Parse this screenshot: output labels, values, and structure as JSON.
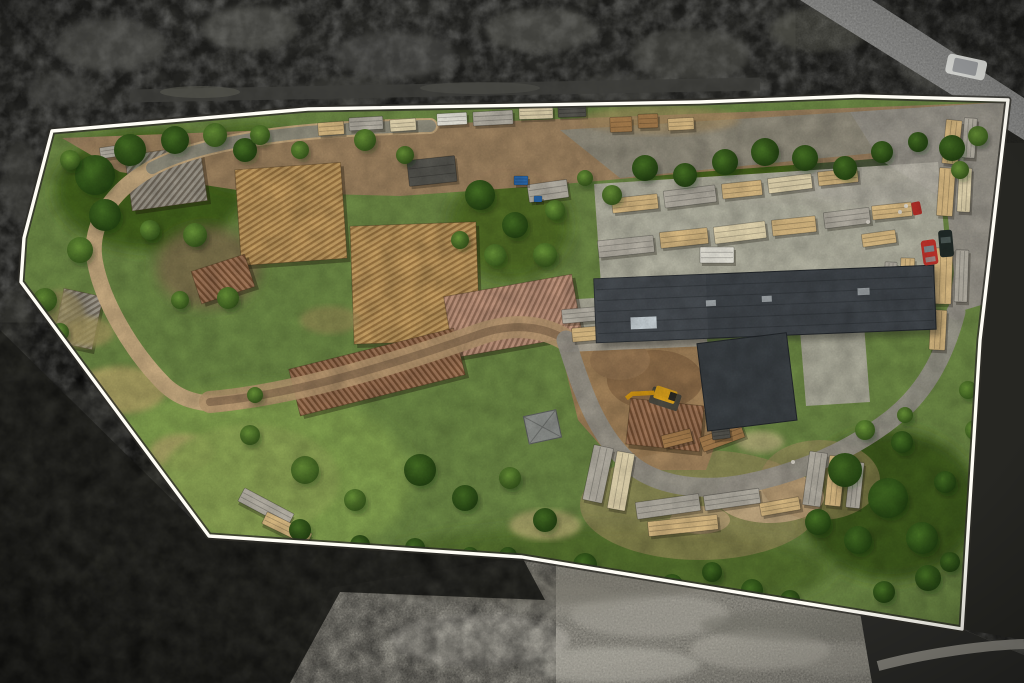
{
  "meta": {
    "description": "Top-down aerial drone photograph of a sawmill and lumber yard property. A white boundary outline highlights the parcel; terrain outside the boundary is desaturated grayscale forest and field, terrain inside is full-colour with green vegetation, dirt roads, log piles, sawn lumber stacks and a large dark-roofed warehouse.",
    "annotation_type": "property-boundary-overlay"
  },
  "boundary": {
    "points": "52,131 308,109 700,102 858,96 1008,100 980,340 962,629 522,557 209,536 21,282 24,238",
    "stroke": "#fffdf5",
    "halo": "#2e2d28"
  },
  "palette": {
    "forest_dark": "#2d2d2a",
    "forest_deep": "#262622",
    "field_gray": "#9b988e",
    "grass": "#6d8845",
    "meadow": "#83a04f",
    "dirt": "#a08262",
    "gravel": "#98948a",
    "concrete": "#b8b4a8",
    "sand": "#d9c49c",
    "road_loop": "#c6aa80",
    "road_track": "#7a6148"
  },
  "objects": {
    "warehouse": {
      "roof": "#41464b",
      "wing": "#3b4044",
      "panel": "#ccd5da"
    },
    "shed": {
      "roof": "#90938f"
    },
    "excavator": {
      "body": "#e2a71f",
      "tracks": "#4c4a40",
      "arm": "#d79a15"
    },
    "cars": {
      "red": "#c2342c",
      "black": "#232c29",
      "white_van": "#d3d4d0",
      "quad": "#b23029"
    }
  },
  "scene": {
    "trees": [
      [
        95,
        175,
        20,
        "d"
      ],
      [
        130,
        150,
        16,
        "d"
      ],
      [
        175,
        140,
        14,
        "d"
      ],
      [
        215,
        135,
        12,
        "m"
      ],
      [
        245,
        150,
        12,
        "d"
      ],
      [
        105,
        215,
        16,
        "d"
      ],
      [
        80,
        250,
        13,
        "m"
      ],
      [
        150,
        230,
        10,
        "m"
      ],
      [
        260,
        135,
        10,
        "m"
      ],
      [
        300,
        150,
        9,
        "m"
      ],
      [
        70,
        160,
        10,
        "m"
      ],
      [
        45,
        300,
        12,
        "m"
      ],
      [
        60,
        332,
        9,
        "m"
      ],
      [
        195,
        235,
        12,
        "m"
      ],
      [
        228,
        298,
        11,
        "m"
      ],
      [
        180,
        300,
        9,
        "m"
      ],
      [
        480,
        195,
        15,
        "d"
      ],
      [
        515,
        225,
        13,
        "d"
      ],
      [
        545,
        255,
        12,
        "m"
      ],
      [
        495,
        255,
        11,
        "m"
      ],
      [
        555,
        210,
        10,
        "m"
      ],
      [
        460,
        240,
        9,
        "m"
      ],
      [
        365,
        140,
        11,
        "m"
      ],
      [
        405,
        155,
        9,
        "m"
      ],
      [
        645,
        168,
        13,
        "d"
      ],
      [
        685,
        175,
        12,
        "d"
      ],
      [
        725,
        162,
        13,
        "d"
      ],
      [
        765,
        152,
        14,
        "d"
      ],
      [
        805,
        158,
        13,
        "d"
      ],
      [
        845,
        168,
        12,
        "d"
      ],
      [
        882,
        152,
        11,
        "d"
      ],
      [
        918,
        142,
        10,
        "d"
      ],
      [
        952,
        148,
        13,
        "d"
      ],
      [
        978,
        136,
        10,
        "m"
      ],
      [
        960,
        170,
        9,
        "m"
      ],
      [
        612,
        195,
        10,
        "m"
      ],
      [
        585,
        178,
        8,
        "m"
      ],
      [
        250,
        435,
        10,
        "m"
      ],
      [
        305,
        470,
        14,
        "m"
      ],
      [
        355,
        500,
        11,
        "m"
      ],
      [
        420,
        470,
        16,
        "d"
      ],
      [
        465,
        498,
        13,
        "d"
      ],
      [
        510,
        478,
        11,
        "m"
      ],
      [
        545,
        520,
        12,
        "d"
      ],
      [
        300,
        530,
        11,
        "d"
      ],
      [
        360,
        545,
        10,
        "d"
      ],
      [
        255,
        395,
        8,
        "m"
      ],
      [
        585,
        565,
        12,
        "d"
      ],
      [
        630,
        582,
        11,
        "d"
      ],
      [
        672,
        585,
        11,
        "d"
      ],
      [
        712,
        572,
        10,
        "d"
      ],
      [
        752,
        590,
        11,
        "d"
      ],
      [
        790,
        600,
        10,
        "d"
      ],
      [
        415,
        548,
        10,
        "d"
      ],
      [
        470,
        556,
        9,
        "d"
      ],
      [
        508,
        556,
        9,
        "d"
      ],
      [
        845,
        470,
        17,
        "d"
      ],
      [
        888,
        498,
        20,
        "d"
      ],
      [
        922,
        538,
        16,
        "d"
      ],
      [
        858,
        540,
        14,
        "d"
      ],
      [
        928,
        578,
        13,
        "d"
      ],
      [
        884,
        592,
        11,
        "d"
      ],
      [
        818,
        522,
        13,
        "d"
      ],
      [
        945,
        482,
        11,
        "d"
      ],
      [
        902,
        442,
        11,
        "d"
      ],
      [
        950,
        562,
        10,
        "d"
      ],
      [
        865,
        430,
        10,
        "m"
      ],
      [
        905,
        415,
        8,
        "m"
      ],
      [
        968,
        390,
        9,
        "m"
      ],
      [
        975,
        430,
        10,
        "m"
      ]
    ],
    "forest_highlights": [
      [
        110,
        45,
        55,
        26,
        "#5d5d58",
        0.55
      ],
      [
        250,
        28,
        48,
        22,
        "#65655f",
        0.5
      ],
      [
        395,
        55,
        60,
        24,
        "#575752",
        0.5
      ],
      [
        540,
        30,
        55,
        22,
        "#60605a",
        0.5
      ],
      [
        690,
        55,
        60,
        26,
        "#55554f",
        0.5
      ],
      [
        820,
        30,
        50,
        22,
        "#626259",
        0.5
      ],
      [
        940,
        70,
        40,
        20,
        "#6a6a64",
        0.45
      ],
      [
        60,
        90,
        35,
        16,
        "#4e4e49",
        0.5
      ],
      [
        350,
        90,
        45,
        14,
        "#454540",
        0.5
      ],
      [
        620,
        88,
        50,
        14,
        "#4a4a45",
        0.5
      ],
      [
        20,
        180,
        18,
        40,
        "#454540",
        0.5
      ],
      [
        15,
        340,
        16,
        50,
        "#3f3f3a",
        0.5
      ],
      [
        90,
        420,
        50,
        30,
        "#45453f",
        0.5
      ],
      [
        190,
        470,
        55,
        32,
        "#3f3f39",
        0.55
      ],
      [
        120,
        560,
        60,
        36,
        "#484842",
        0.5
      ],
      [
        270,
        600,
        55,
        30,
        "#3c3c37",
        0.5
      ],
      [
        60,
        645,
        45,
        26,
        "#44443e",
        0.5
      ],
      [
        360,
        640,
        50,
        26,
        "#3a3a35",
        0.45
      ],
      [
        300,
        520,
        40,
        22,
        "#42423c",
        0.5
      ],
      [
        430,
        600,
        40,
        24,
        "#3e3e38",
        0.45
      ],
      [
        1012,
        200,
        14,
        45,
        "#3b3b36",
        0.5
      ],
      [
        1010,
        480,
        14,
        50,
        "#35352f",
        0.5
      ],
      [
        990,
        580,
        30,
        26,
        "#30302b",
        0.5
      ],
      [
        940,
        640,
        45,
        26,
        "#353530",
        0.5
      ],
      [
        1000,
        660,
        30,
        18,
        "#3a3a34",
        0.5
      ]
    ],
    "field_streaks": [
      [
        480,
        640,
        90,
        26,
        "#b7b4aa",
        0.5
      ],
      [
        650,
        615,
        80,
        22,
        "#a8a59b",
        0.5
      ],
      [
        760,
        650,
        70,
        20,
        "#b2afa4",
        0.45
      ],
      [
        560,
        600,
        60,
        16,
        "#8f8c82",
        0.5
      ],
      [
        420,
        590,
        50,
        14,
        "#98958b",
        0.5
      ],
      [
        840,
        660,
        50,
        16,
        "#9a978d",
        0.4
      ],
      [
        610,
        665,
        90,
        18,
        "#c0bdb2",
        0.45
      ],
      [
        700,
        585,
        40,
        12,
        "#87847a",
        0.5
      ],
      [
        540,
        585,
        160,
        18,
        "#6f6d64",
        0.5
      ],
      [
        820,
        625,
        120,
        16,
        "#6b6960",
        0.5
      ],
      [
        350,
        560,
        70,
        14,
        "#75736a",
        0.5
      ]
    ],
    "dry_patches": [
      [
        120,
        390,
        46,
        24,
        "#b3a468",
        0.85
      ],
      [
        88,
        332,
        26,
        15,
        "#ac9e64",
        0.8
      ],
      [
        182,
        452,
        32,
        18,
        "#b8ab6e",
        0.8
      ],
      [
        140,
        502,
        42,
        20,
        "#b0a367",
        0.75
      ],
      [
        250,
        480,
        90,
        55,
        "#8da355",
        0.9
      ],
      [
        545,
        525,
        36,
        15,
        "#b5ab72",
        0.8
      ],
      [
        760,
        442,
        24,
        11,
        "#c0b183",
        0.7
      ],
      [
        660,
        120,
        80,
        14,
        "#a98f63",
        0.6
      ],
      [
        330,
        320,
        30,
        14,
        "#9b8a58",
        0.6
      ],
      [
        60,
        320,
        26,
        30,
        "#9c8f5e",
        0.7
      ]
    ],
    "log_piles": [
      [
        128,
        150,
        76,
        56,
        -8,
        "gray"
      ],
      [
        238,
        166,
        106,
        96,
        -4,
        "tan"
      ],
      [
        352,
        224,
        126,
        118,
        -2,
        "tan"
      ],
      [
        448,
        285,
        130,
        62,
        -10,
        "pink"
      ],
      [
        292,
        348,
        170,
        48,
        -14,
        "brown"
      ],
      [
        58,
        292,
        40,
        54,
        12,
        "gray"
      ],
      [
        628,
        402,
        74,
        46,
        6,
        "brown"
      ],
      [
        195,
        262,
        56,
        34,
        -18,
        "brown"
      ]
    ],
    "lumber_stacks": [
      [
        318,
        122,
        26,
        13,
        -4,
        "tan"
      ],
      [
        349,
        117,
        34,
        13,
        -3,
        "gray"
      ],
      [
        390,
        119,
        26,
        12,
        -4,
        "light"
      ],
      [
        437,
        113,
        30,
        12,
        -3,
        "white"
      ],
      [
        473,
        111,
        40,
        14,
        -3,
        "gray"
      ],
      [
        519,
        107,
        34,
        12,
        -2,
        "light"
      ],
      [
        558,
        105,
        28,
        12,
        -2,
        "dark"
      ],
      [
        610,
        117,
        22,
        15,
        -2,
        "brown"
      ],
      [
        638,
        114,
        20,
        14,
        -2,
        "brown"
      ],
      [
        668,
        118,
        26,
        12,
        -3,
        "tan"
      ],
      [
        100,
        146,
        26,
        11,
        -8,
        "gray"
      ],
      [
        408,
        158,
        48,
        26,
        -6,
        "dark"
      ],
      [
        528,
        182,
        40,
        18,
        -8,
        "gray"
      ],
      [
        514,
        176,
        14,
        9,
        0,
        "blue"
      ],
      [
        534,
        196,
        8,
        6,
        0,
        "blue"
      ],
      [
        612,
        196,
        46,
        15,
        -6,
        "tan"
      ],
      [
        664,
        188,
        52,
        17,
        -7,
        "gray"
      ],
      [
        722,
        182,
        40,
        15,
        -6,
        "tan"
      ],
      [
        768,
        176,
        44,
        15,
        -7,
        "light"
      ],
      [
        818,
        170,
        40,
        14,
        -6,
        "tan"
      ],
      [
        598,
        238,
        56,
        17,
        -6,
        "gray"
      ],
      [
        660,
        230,
        48,
        16,
        -6,
        "tan"
      ],
      [
        714,
        224,
        52,
        17,
        -7,
        "light"
      ],
      [
        772,
        218,
        44,
        16,
        -6,
        "tan"
      ],
      [
        824,
        210,
        46,
        16,
        -7,
        "gray"
      ],
      [
        872,
        204,
        40,
        14,
        -6,
        "tan"
      ],
      [
        562,
        308,
        40,
        14,
        -5,
        "gray"
      ],
      [
        606,
        300,
        48,
        15,
        -6,
        "tan"
      ],
      [
        572,
        326,
        52,
        14,
        -5,
        "tan"
      ],
      [
        620,
        318,
        40,
        12,
        -6,
        "light"
      ],
      [
        700,
        247,
        34,
        16,
        0,
        "white"
      ],
      [
        944,
        120,
        16,
        44,
        6,
        "tan"
      ],
      [
        963,
        118,
        13,
        40,
        4,
        "gray"
      ],
      [
        938,
        168,
        16,
        48,
        4,
        "tan"
      ],
      [
        958,
        168,
        13,
        44,
        3,
        "light"
      ],
      [
        934,
        248,
        18,
        56,
        2,
        "tan"
      ],
      [
        955,
        250,
        13,
        52,
        2,
        "gray"
      ],
      [
        930,
        310,
        16,
        40,
        3,
        "tan"
      ],
      [
        900,
        258,
        14,
        48,
        2,
        "tan"
      ],
      [
        884,
        262,
        12,
        44,
        3,
        "gray"
      ],
      [
        862,
        232,
        34,
        13,
        -8,
        "tan"
      ],
      [
        588,
        446,
        20,
        56,
        12,
        "gray"
      ],
      [
        612,
        452,
        18,
        58,
        10,
        "light"
      ],
      [
        636,
        498,
        64,
        17,
        -8,
        "gray"
      ],
      [
        648,
        518,
        70,
        15,
        -6,
        "tan"
      ],
      [
        704,
        492,
        56,
        15,
        -8,
        "gray"
      ],
      [
        760,
        500,
        40,
        13,
        -10,
        "tan"
      ],
      [
        806,
        452,
        18,
        54,
        8,
        "gray"
      ],
      [
        827,
        456,
        16,
        50,
        6,
        "tan"
      ],
      [
        848,
        462,
        14,
        46,
        6,
        "gray"
      ],
      [
        700,
        430,
        44,
        15,
        -20,
        "brown"
      ],
      [
        662,
        432,
        30,
        13,
        -14,
        "brown"
      ],
      [
        238,
        500,
        56,
        15,
        28,
        "gray"
      ],
      [
        262,
        522,
        50,
        13,
        26,
        "tan"
      ],
      [
        712,
        386,
        20,
        13,
        -7,
        "white"
      ],
      [
        736,
        352,
        22,
        9,
        -7,
        "brown"
      ],
      [
        722,
        404,
        16,
        8,
        -7,
        "gray"
      ],
      [
        752,
        396,
        14,
        7,
        -7,
        "light"
      ],
      [
        744,
        368,
        12,
        6,
        -7,
        "gray"
      ],
      [
        712,
        428,
        18,
        11,
        -7,
        "dark"
      ]
    ],
    "people": [
      [
        868,
        222
      ],
      [
        900,
        212
      ],
      [
        906,
        206
      ],
      [
        793,
        462
      ]
    ]
  }
}
